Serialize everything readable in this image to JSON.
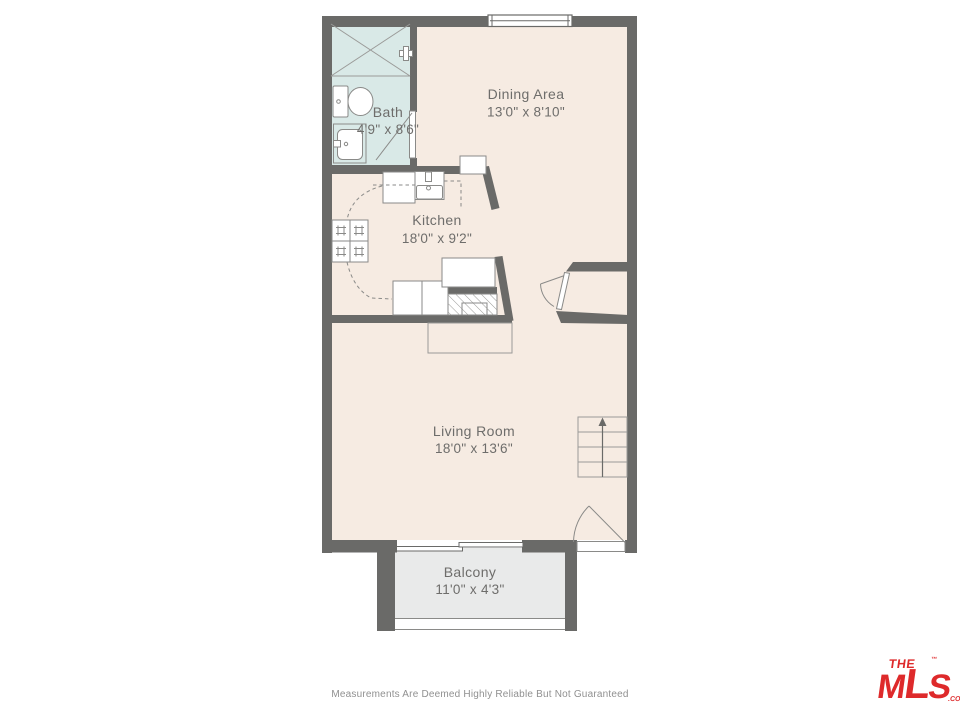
{
  "colors": {
    "wall": "#6a6a68",
    "floor": "#f6ebe2",
    "bath": "#d9e9e7",
    "balcony": "#e9eaea",
    "label": "#6e6d6b",
    "thin": "#9a9a98",
    "fixline": "#8a8a88",
    "logored": "#de2a2b",
    "disclaimer": "#909090"
  },
  "rooms": [
    {
      "id": "bath",
      "name": "Bath",
      "dims": "4'9\" x 8'6\""
    },
    {
      "id": "dining",
      "name": "Dining Area",
      "dims": "13'0\" x 8'10\""
    },
    {
      "id": "kitchen",
      "name": "Kitchen",
      "dims": "18'0\" x 9'2\""
    },
    {
      "id": "living",
      "name": "Living Room",
      "dims": "18'0\" x 13'6\""
    },
    {
      "id": "balcony",
      "name": "Balcony",
      "dims": "11'0\" x 4'3\""
    }
  ],
  "footer": {
    "disclaimer": "Measurements Are Deemed Highly Reliable But Not Guaranteed"
  },
  "logo": {
    "the": "THE",
    "tm": "™",
    "m": "M",
    "l": "L",
    "s": "S",
    "com": ".COM"
  }
}
